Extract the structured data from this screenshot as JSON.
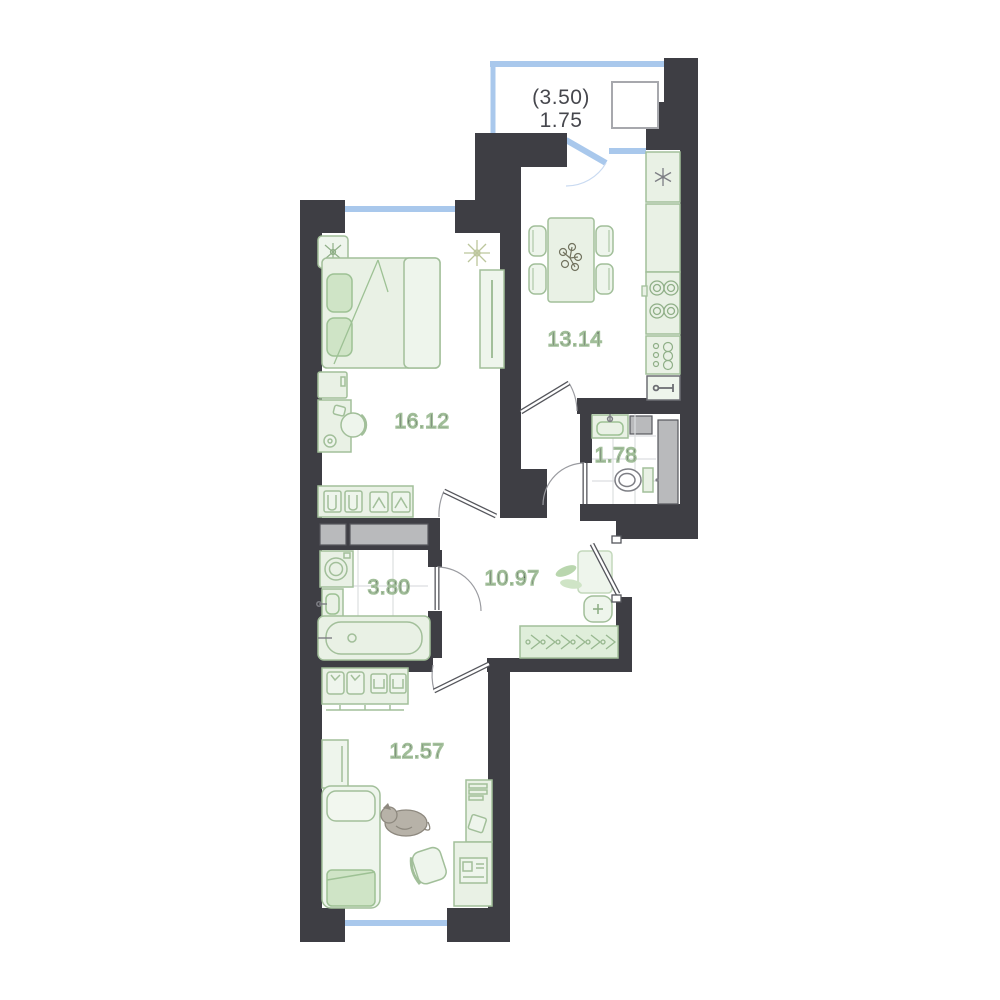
{
  "plan": {
    "type": "apartment-floor-plan",
    "rooms": {
      "balcony": {
        "label_total": "(3.50)",
        "label": "1.75"
      },
      "kitchen": {
        "label": "13.14"
      },
      "bedroom": {
        "label": "16.12"
      },
      "wc": {
        "label": "1.78"
      },
      "hallway": {
        "label": "10.97"
      },
      "bathroom": {
        "label": "3.80"
      },
      "bedroom2": {
        "label": "12.57"
      }
    },
    "colors": {
      "wall": "#3e3e44",
      "furniture_fill": "#e9f1e5",
      "furniture_stroke": "#a2bf9a",
      "accent_green": "#cfe4c6",
      "window_blue": "#a9c8ec",
      "shaft_gray": "#b9babc",
      "tile_line": "#dcdee0",
      "door_stroke": "#55565c",
      "label_text": "#46474d"
    }
  }
}
